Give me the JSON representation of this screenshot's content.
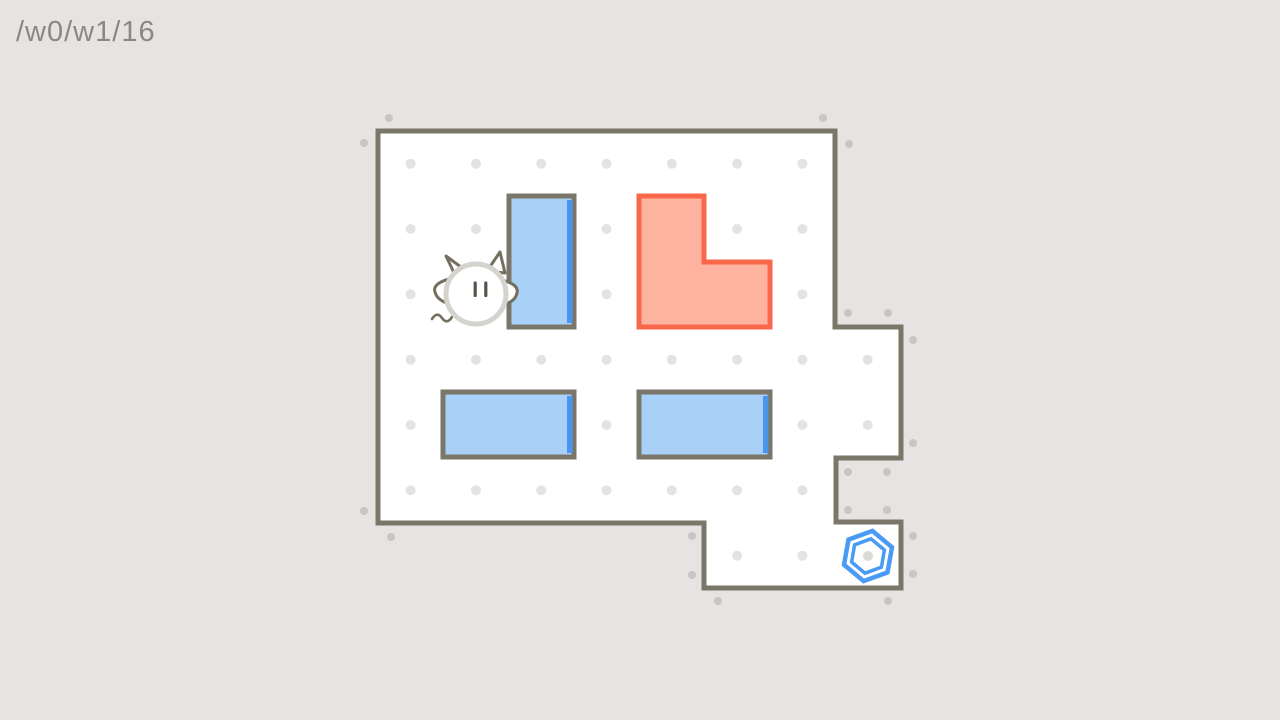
{
  "header": {
    "level_path": "/w0/w1/16"
  },
  "palette": {
    "background": "#e5e4e2",
    "room_fill": "#ffffff",
    "wall": "#7a7669",
    "dot_interior": "#e4e3e1",
    "dot_exterior": "#c7c6c4",
    "block_blue_fill": "#a9d1f8",
    "block_blue_edge": "#4a95ee",
    "block_red_fill": "#feb3a1",
    "block_red_border": "#fa684b",
    "goal_blue": "#4a9bf5",
    "goal_center_dot": "#dbdad7",
    "player_outline": "#d5d3ce",
    "player_features": "#57544c",
    "player_horns": "#74705f",
    "header_text": "#8c8880"
  },
  "room": {
    "outline": [
      [
        378,
        131
      ],
      [
        835,
        131
      ],
      [
        835,
        327
      ],
      [
        901,
        327
      ],
      [
        901,
        458
      ],
      [
        836,
        458
      ],
      [
        836,
        522
      ],
      [
        901,
        522
      ],
      [
        901,
        588
      ],
      [
        704,
        588
      ],
      [
        704,
        523
      ],
      [
        378,
        523
      ]
    ],
    "wall_thickness": 5
  },
  "dots": {
    "radius_interior": 5,
    "radius_exterior": 4,
    "interior": [
      [
        410.6,
        163.7
      ],
      [
        475.9,
        163.7
      ],
      [
        541.2,
        163.7
      ],
      [
        606.5,
        163.7
      ],
      [
        671.8,
        163.7
      ],
      [
        737.1,
        163.7
      ],
      [
        802.4,
        163.7
      ],
      [
        410.6,
        229.0
      ],
      [
        475.9,
        229.0
      ],
      [
        606.5,
        229.0
      ],
      [
        737.1,
        229.0
      ],
      [
        802.4,
        229.0
      ],
      [
        410.6,
        294.3
      ],
      [
        606.5,
        294.3
      ],
      [
        802.4,
        294.3
      ],
      [
        410.6,
        359.7
      ],
      [
        475.9,
        359.7
      ],
      [
        541.2,
        359.7
      ],
      [
        606.5,
        359.7
      ],
      [
        671.8,
        359.7
      ],
      [
        737.1,
        359.7
      ],
      [
        802.4,
        359.7
      ],
      [
        867.7,
        359.7
      ],
      [
        410.6,
        425.0
      ],
      [
        606.5,
        425.0
      ],
      [
        802.4,
        425.0
      ],
      [
        867.7,
        425.0
      ],
      [
        410.6,
        490.3
      ],
      [
        475.9,
        490.3
      ],
      [
        541.2,
        490.3
      ],
      [
        606.5,
        490.3
      ],
      [
        671.8,
        490.3
      ],
      [
        737.1,
        490.3
      ],
      [
        802.4,
        490.3
      ],
      [
        737.1,
        555.7
      ],
      [
        802.4,
        555.7
      ]
    ],
    "exterior": [
      [
        389,
        118
      ],
      [
        823,
        118
      ],
      [
        364,
        143
      ],
      [
        849,
        144
      ],
      [
        848,
        313
      ],
      [
        888,
        313
      ],
      [
        913,
        340
      ],
      [
        913,
        443
      ],
      [
        848,
        472
      ],
      [
        887,
        472
      ],
      [
        848,
        510
      ],
      [
        887,
        510
      ],
      [
        913,
        536
      ],
      [
        913,
        574
      ],
      [
        888,
        601
      ],
      [
        718,
        601
      ],
      [
        692,
        536
      ],
      [
        692,
        575
      ],
      [
        364,
        511
      ],
      [
        391,
        537
      ]
    ]
  },
  "blocks": [
    {
      "id": "tall-blue-box",
      "style": "blue",
      "shape": "rect",
      "x": 509,
      "y": 196,
      "w": 65,
      "h": 131
    },
    {
      "id": "l-shaped-red-box",
      "style": "red",
      "shape": "polygon",
      "points": [
        [
          639,
          196
        ],
        [
          704,
          196
        ],
        [
          704,
          262
        ],
        [
          770,
          262
        ],
        [
          770,
          327
        ],
        [
          639,
          327
        ]
      ]
    },
    {
      "id": "wide-blue-box-left",
      "style": "blue",
      "shape": "rect",
      "x": 443,
      "y": 392,
      "w": 131,
      "h": 65
    },
    {
      "id": "wide-blue-box-right",
      "style": "blue",
      "shape": "rect",
      "x": 639,
      "y": 392,
      "w": 131,
      "h": 65
    }
  ],
  "player": {
    "cx": 476,
    "cy": 294,
    "r": 30
  },
  "goal": {
    "cx": 868,
    "cy": 556,
    "outer_r": 25.5,
    "inner_r": 17.5,
    "rotation_deg": 10,
    "center_dot_r": 5
  }
}
